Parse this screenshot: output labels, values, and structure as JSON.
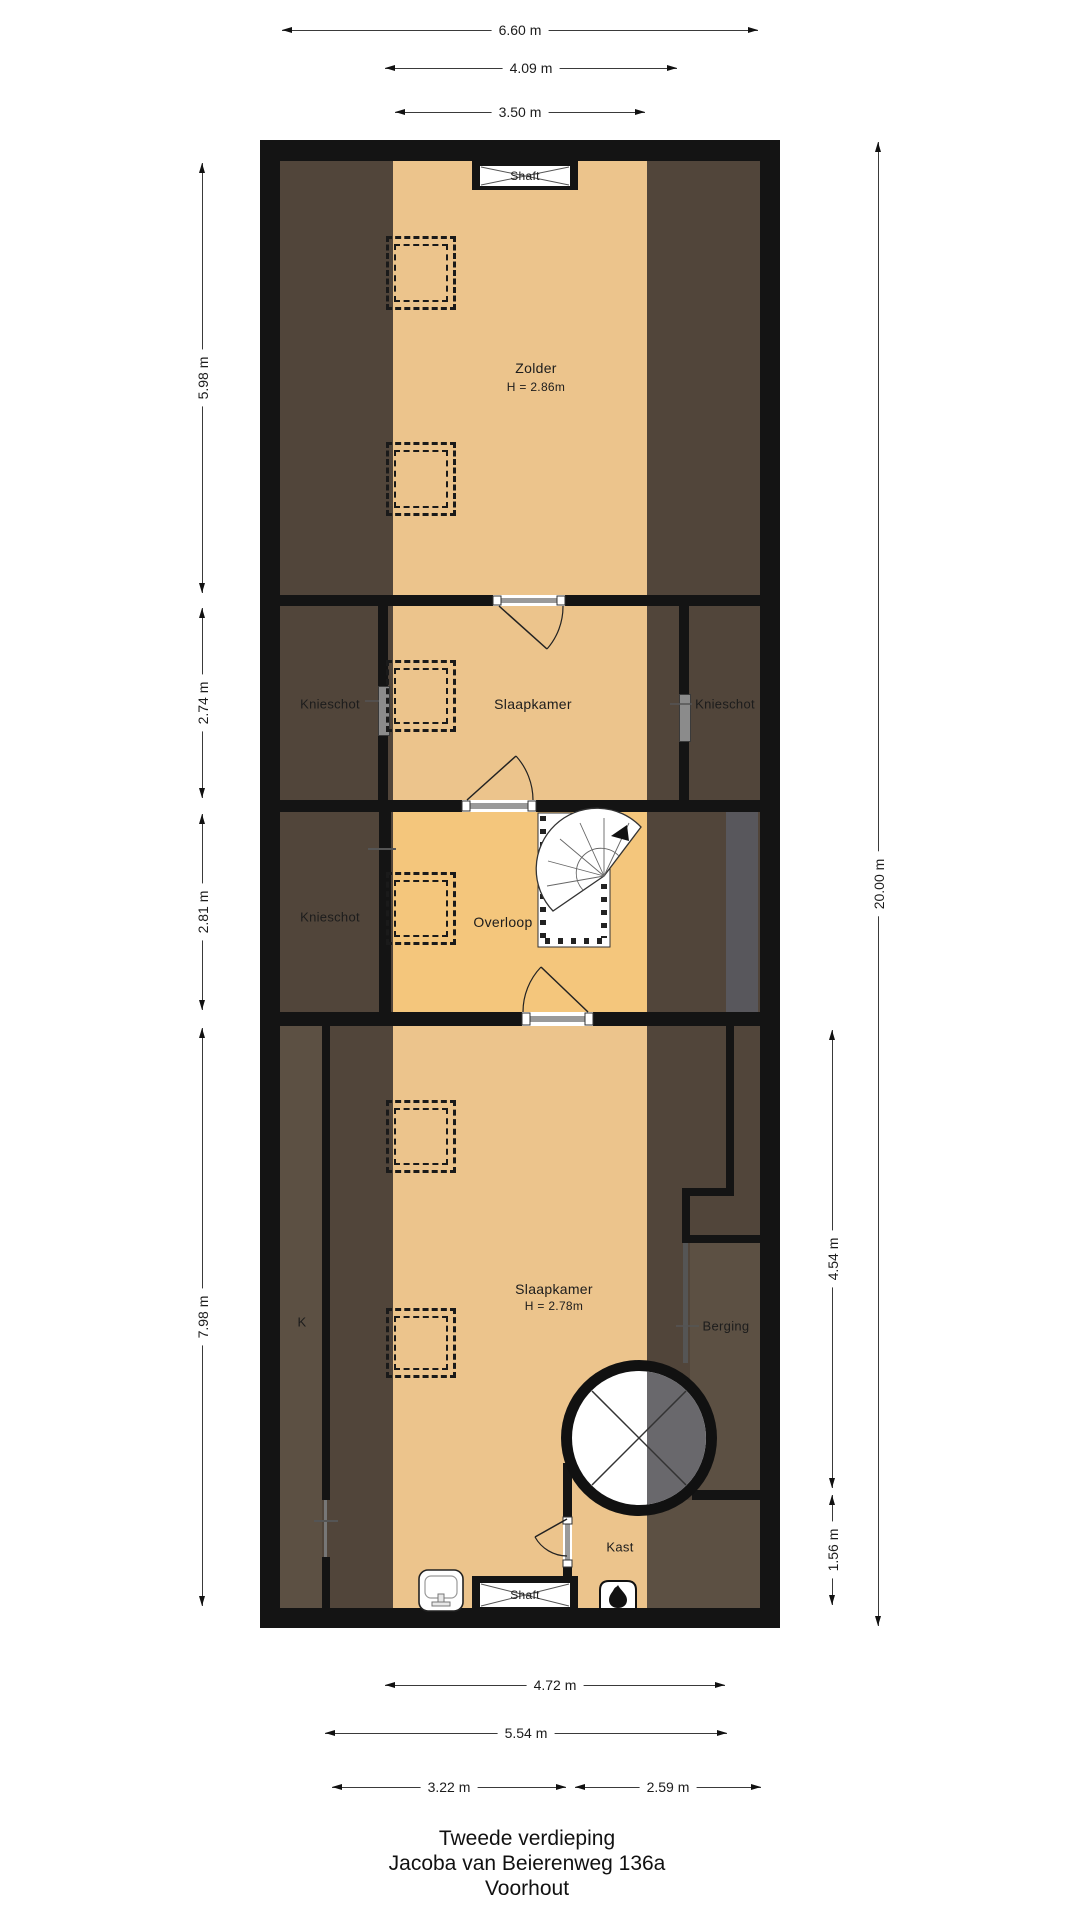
{
  "title": {
    "floor": "Tweede verdieping",
    "address": "Jacoba van Beierenweg 136a",
    "city": "Voorhout"
  },
  "rooms": {
    "zolder": {
      "name": "Zolder",
      "height": "H = 2.86m"
    },
    "slaapkamer_boven": {
      "name": "Slaapkamer"
    },
    "knieschot_links": {
      "name": "Knieschot"
    },
    "knieschot_rechts": {
      "name": "Knieschot"
    },
    "knieschot_overloop": {
      "name": "Knieschot"
    },
    "overloop": {
      "name": "Overloop"
    },
    "k": {
      "name": "K"
    },
    "slaapkamer_onder": {
      "name": "Slaapkamer",
      "height": "H = 2.78m"
    },
    "berging": {
      "name": "Berging"
    },
    "kast": {
      "name": "Kast"
    },
    "shaft_boven": {
      "name": "Shaft"
    },
    "shaft_onder": {
      "name": "Shaft"
    }
  },
  "dimensions": {
    "top": [
      {
        "label": "6.60 m"
      },
      {
        "label": "4.09 m"
      },
      {
        "label": "3.50 m"
      }
    ],
    "left": [
      {
        "label": "5.98 m"
      },
      {
        "label": "2.74 m"
      },
      {
        "label": "2.81 m"
      },
      {
        "label": "7.98 m"
      }
    ],
    "right": [
      {
        "label": "20.00 m"
      },
      {
        "label": "4.54 m"
      },
      {
        "label": "1.56 m"
      }
    ],
    "bottom": [
      {
        "label": "4.72 m"
      },
      {
        "label": "5.54 m"
      },
      {
        "label": "3.22 m"
      },
      {
        "label": "2.59 m"
      }
    ]
  },
  "colors": {
    "wall": "#141414",
    "floor-tan": "#ecc48c",
    "floor-orange": "#f4c67c",
    "slope-brown": "#51453a",
    "panel-brown": "#5c5043",
    "gray-zone": "#58575c",
    "circle-gray": "#69686c",
    "bg": "#ffffff"
  }
}
